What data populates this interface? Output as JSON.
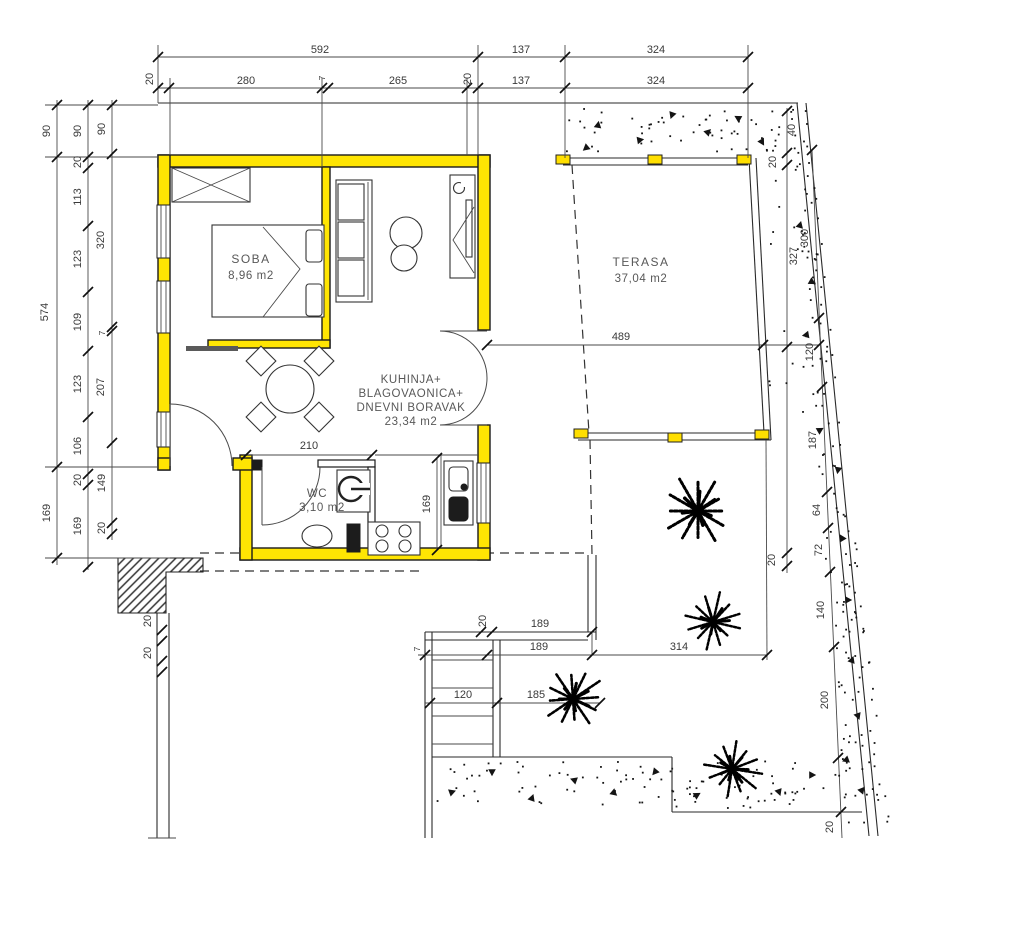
{
  "meta": {
    "type": "architectural floor plan",
    "language": "hr",
    "units": "cm"
  },
  "colors": {
    "wall_highlight": "#ffe503",
    "terrace_marker": "#ffdf00",
    "line": "#1b1b1b",
    "dim_text": "#3a3a3a",
    "room_text": "#585858",
    "paper": "#ffffff"
  },
  "rooms": {
    "soba": {
      "name": "SOBA",
      "area": "8,96 m2"
    },
    "living": {
      "line1": "KUHINJA+",
      "line2": "BLAGOVAONICA+",
      "line3": "DNEVNI BORAVAK",
      "area": "23,34 m2"
    },
    "wc": {
      "name": "WC",
      "area": "3,10 m2"
    },
    "terasa": {
      "name": "TERASA",
      "area": "37,04 m2"
    }
  },
  "dims": {
    "t1": "592",
    "t2": "137",
    "t3": "324",
    "t4": "20",
    "t5": "280",
    "t6": "7",
    "t7": "265",
    "t8": "20",
    "t9": "137",
    "t10": "324",
    "l1": "90",
    "l2": "574",
    "l3": "169",
    "l4": "90",
    "l5": "20",
    "l6": "113",
    "l7": "123",
    "l8": "109",
    "l9": "123",
    "l10": "106",
    "l11": "20",
    "l12": "169",
    "l13": "90",
    "l14": "320",
    "l15": "7",
    "l16": "207",
    "l17": "149",
    "l18": "20",
    "r1": "40",
    "r2": "20",
    "r3": "327",
    "r4": "20",
    "r5": "300",
    "r6": "120",
    "r7": "187",
    "r8": "64",
    "r9": "72",
    "r10": "140",
    "r11": "200",
    "r12": "20",
    "i1": "210",
    "i2": "169",
    "i3": "489",
    "b1": "20",
    "b2": "189",
    "b3": "7",
    "b4": "189",
    "b5": "314",
    "b6": "120",
    "b7": "185",
    "b8": "20",
    "b9": "20"
  }
}
